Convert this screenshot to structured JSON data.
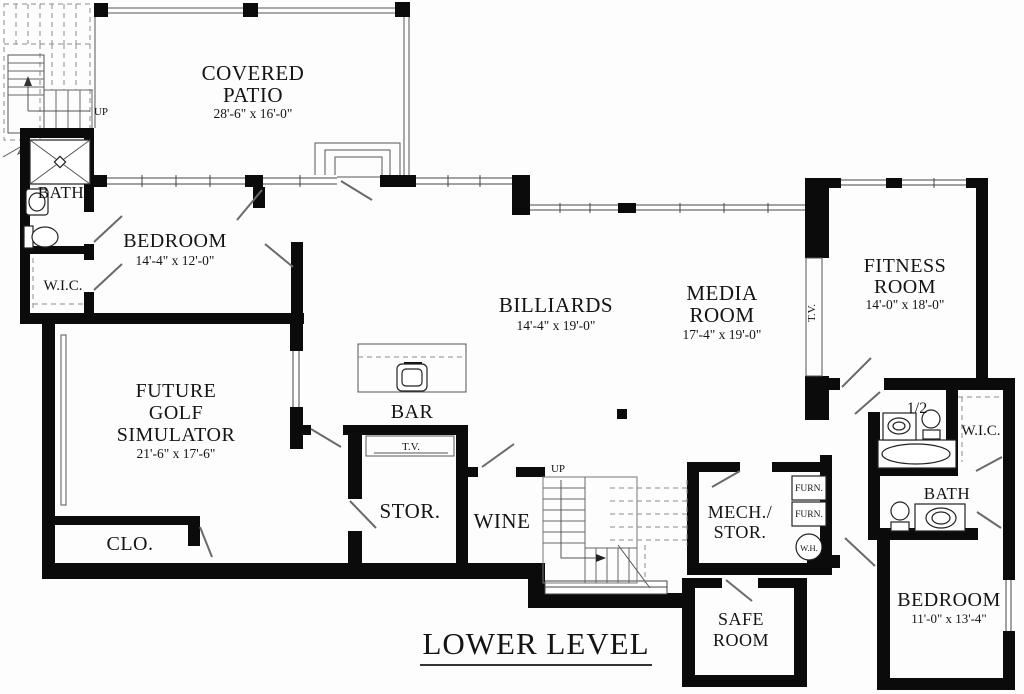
{
  "title": "LOWER LEVEL",
  "labels": {
    "up_left": "UP",
    "up_center": "UP"
  },
  "rooms": {
    "covered_patio": {
      "line1": "COVERED",
      "line2": "PATIO",
      "dims": "28'-6\" x 16'-0\""
    },
    "bath1": {
      "name": "BATH"
    },
    "wic1": {
      "name": "W.I.C."
    },
    "bedroom1": {
      "name": "BEDROOM",
      "dims": "14'-4\" x 12'-0\""
    },
    "golf": {
      "line1": "FUTURE",
      "line2": "GOLF",
      "line3": "SIMULATOR",
      "dims": "21'-6\" x 17'-6\""
    },
    "clo": {
      "name": "CLO."
    },
    "bar": {
      "name": "BAR"
    },
    "tv_nook": {
      "name": "T.V."
    },
    "stor": {
      "name": "STOR."
    },
    "wine": {
      "name": "WINE"
    },
    "billiards": {
      "name": "BILLIARDS",
      "dims": "14'-4\" x 19'-0\""
    },
    "media": {
      "line1": "MEDIA",
      "line2": "ROOM",
      "dims": "17'-4\" x 19'-0\""
    },
    "fitness": {
      "line1": "FITNESS",
      "line2": "ROOM",
      "dims": "14'-0\" x 18'-0\""
    },
    "tv_media": {
      "name": "T.V."
    },
    "half_bath": {
      "name": "1/2"
    },
    "wic2": {
      "name": "W.I.C."
    },
    "bath2": {
      "name": "BATH"
    },
    "bedroom2": {
      "name": "BEDROOM",
      "dims": "11'-0\" x 13'-4\""
    },
    "mech": {
      "line1": "MECH./",
      "line2": "STOR."
    },
    "safe": {
      "line1": "SAFE",
      "line2": "ROOM"
    },
    "furn1": "FURN.",
    "furn2": "FURN.",
    "wh": "W.H."
  }
}
